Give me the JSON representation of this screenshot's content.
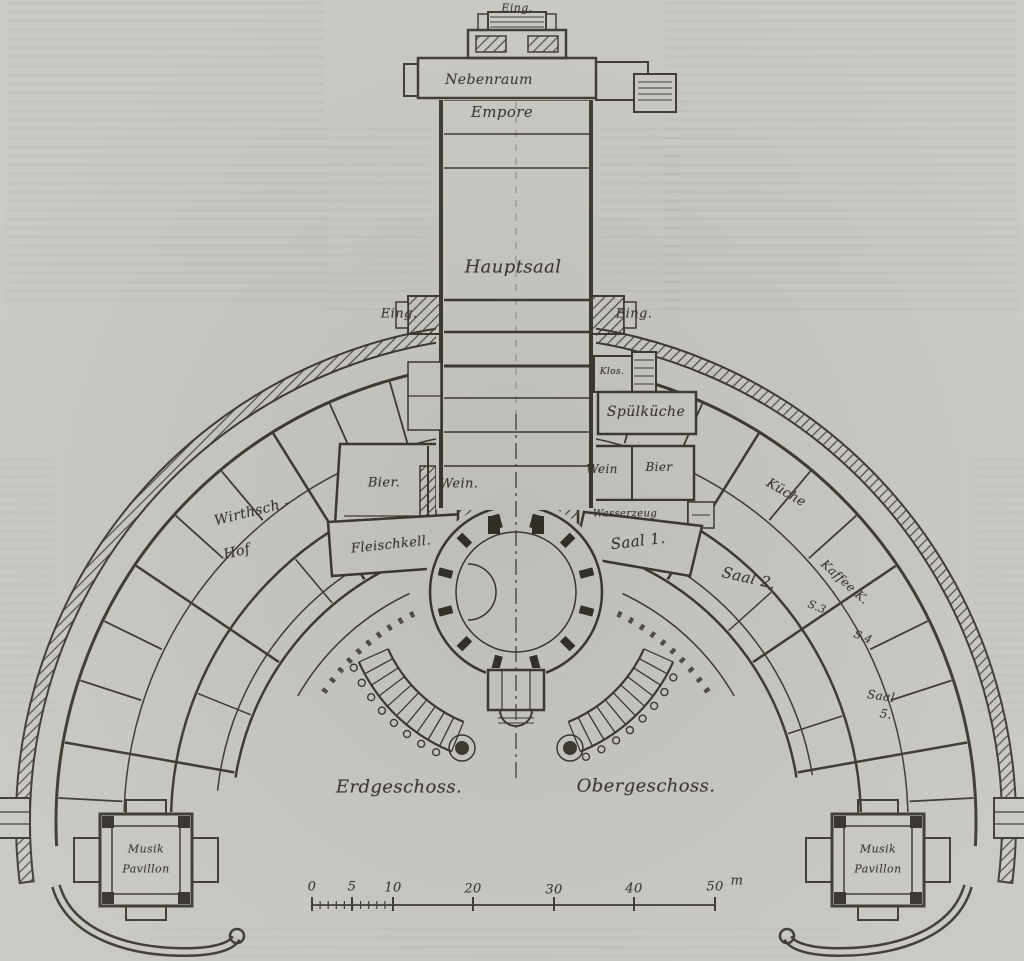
{
  "plan": {
    "tower": {
      "entrance_top": "Eing.",
      "nebenraum": "Nebenraum",
      "empore": "Empore",
      "hauptsaal": "Hauptsaal",
      "entrance_left": "Eing.",
      "entrance_right": "Eing.",
      "kloset": "Klos.",
      "spuelkueche": "Spülküche"
    },
    "cellars_left": {
      "bier": "Bier.",
      "wein": "Wein."
    },
    "service_right": {
      "wein": "Wein",
      "bier": "Bier",
      "wasserzeug": "Wasserzeug"
    },
    "ring_rooms": {
      "wirthschaftshof_line1": "Wirthsch.-",
      "wirthschaftshof_line2": "Hof",
      "fleischkeller": "Fleischkell.",
      "saal1": "Saal 1.",
      "saal2": "Saal 2.",
      "kueche": "Küche",
      "kaffee_kueche": "Kaffee K.",
      "saal3": "S.3",
      "saal4": "S.4",
      "saal5_line1": "Saal",
      "saal5_line2": "5."
    },
    "pavilion_left": {
      "line1": "Musik",
      "line2": "Pavillon"
    },
    "pavilion_right": {
      "line1": "Musik",
      "line2": "Pavillon"
    },
    "captions": {
      "left_half": "Erdgeschoss.",
      "right_half": "Obergeschoss."
    },
    "scale_bar": {
      "tick_labels": [
        "0",
        "5",
        "10",
        "20",
        "30",
        "40",
        "50"
      ],
      "unit": "m"
    },
    "colors": {
      "paper": "#c8c7c2",
      "ink": "#3a372f"
    }
  }
}
